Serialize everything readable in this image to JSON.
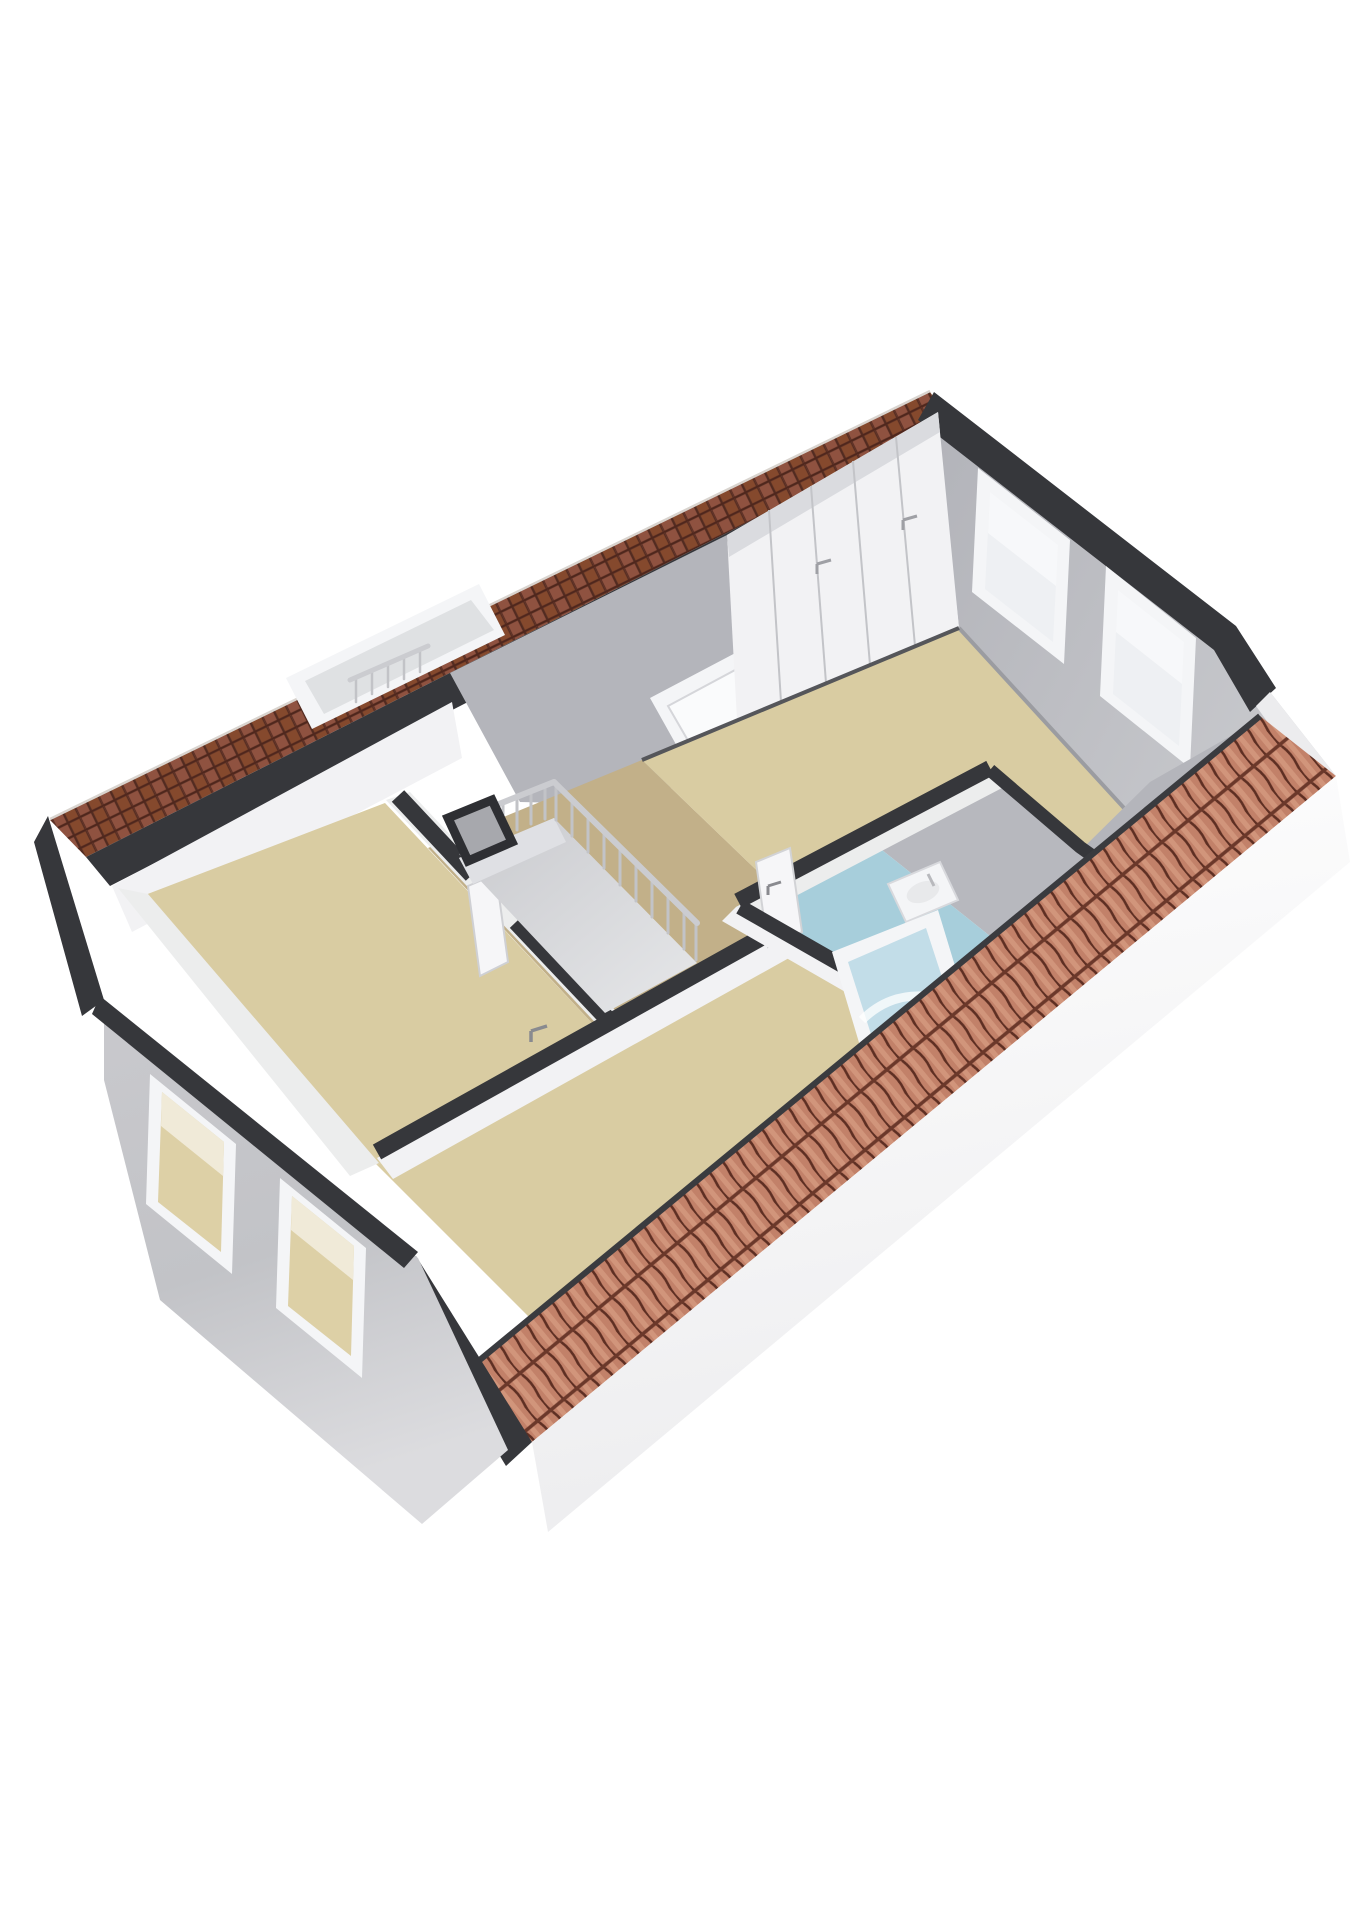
{
  "scene": {
    "type": "3d-floorplan-render",
    "description": "Isometric cutaway 3D floor plan of an attic floor: three tan-floored bedrooms, central landing with stairwell railing and skylights, blue-floored bathroom with sink and shower, built-in closet wall, gable walls with windows, terracotta tiled roof edges",
    "background": "#ffffff"
  },
  "colors": {
    "background": "#ffffff",
    "shingle_base": "#7d4437",
    "pantile_base": "#c28169",
    "edge_dark": "#36373b",
    "edge_dark_soft": "#55565a",
    "fascia": "#f6f6f7",
    "ext_gray": "#c6c7cb",
    "gable_gray": "#b7b8be",
    "slope_gray": "#b4b5bb",
    "int_white": "#f2f2f4",
    "int_face": "#eceded",
    "floor_tan": "#d9cca2",
    "floor_tan_dark": "#c2b089",
    "floor_blue": "#a7cedb",
    "window_frame": "#f4f5f7",
    "glass": "#eef0f3",
    "glass_tan": "#ddd0a6",
    "railing": "#c7c8cc",
    "fixture": "#f4f5f7",
    "void_gray": "#d4d5d9",
    "door_white": "#f6f6f8",
    "shower_glass": "#c2dde8",
    "sink_basin": "#e8e9eb"
  },
  "building": {
    "floor_label": "attic floor",
    "roof": {
      "nw_edge": "flat shingle tiles, dark brown",
      "se_edge": "ridged pantiles, terracotta",
      "caps": "dark gray cut edges"
    },
    "rooms": [
      {
        "id": "bedroom-right",
        "floor_color_key": "floor_tan",
        "features": [
          "built-in closet wall with 5 doors",
          "2 gable windows"
        ]
      },
      {
        "id": "landing",
        "floor_color_key": "floor_tan_dark",
        "features": [
          "stairwell with railing",
          "large roof window",
          "small skylight",
          "duct shaft"
        ]
      },
      {
        "id": "bedroom-left",
        "floor_color_key": "floor_tan",
        "features": [
          "open door to landing"
        ]
      },
      {
        "id": "bedroom-bottom",
        "floor_color_key": "floor_tan",
        "features": [
          "2 facade windows",
          "door handle to landing"
        ]
      },
      {
        "id": "bathroom",
        "floor_color_key": "floor_blue",
        "features": [
          "wall-hung sink",
          "shower tray",
          "door to landing"
        ]
      }
    ],
    "window_counts": {
      "ne_gable": 2,
      "sw_facade": 2,
      "roof_windows": 2
    }
  }
}
